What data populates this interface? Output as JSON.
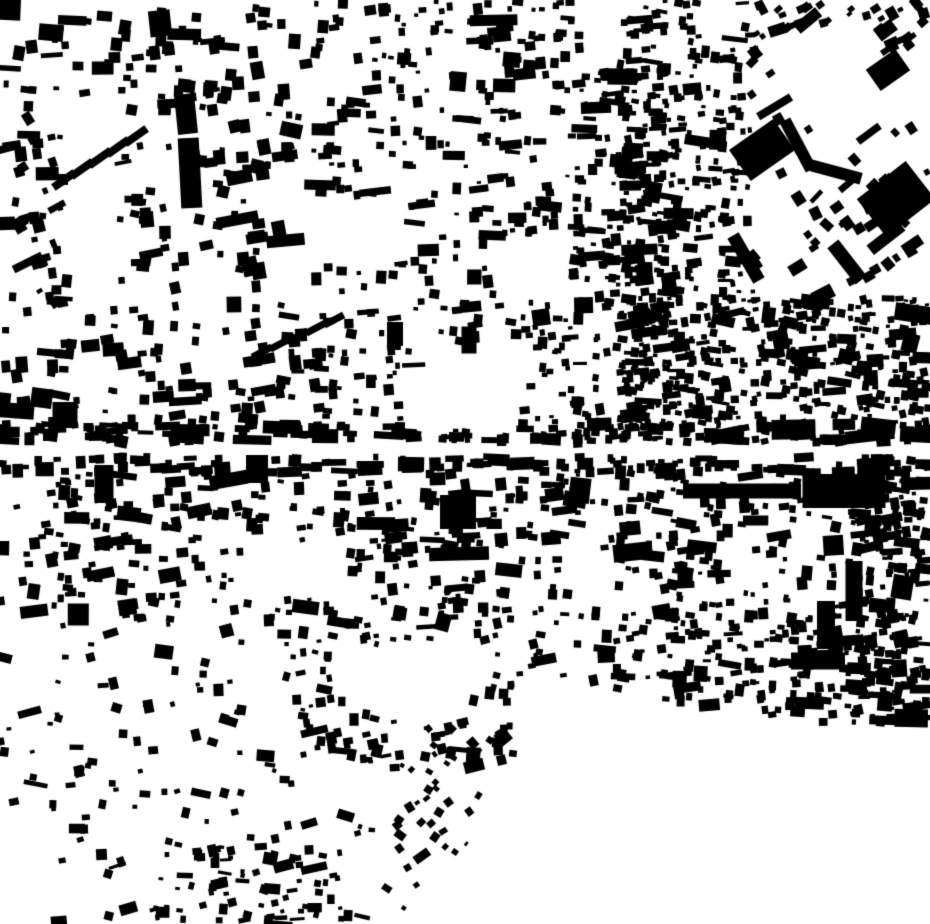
{
  "map_data": {
    "type": "figure-ground-building-footprints",
    "description": "Monochrome figure-ground map of a dense urban fabric: black building footprints on a white ground. Dense fine-grain blocks to the east, large industrial/estate slabs in the north-east, twin tall slab buildings in the north-west, a horizontal street corridor across the middle lined with row buildings, a large commercial slab at centre-right, and an empty (unbuilt) wedge in the south-east corner.",
    "width": 930,
    "height": 924,
    "background_color": "#ffffff",
    "building_color": "#000000",
    "seed": 7,
    "base_elongation_chance": 0.15,
    "big_building_chance": 0.06,
    "districts": [
      {
        "name": "top-left-upper",
        "x": 6,
        "y": 4,
        "w": 300,
        "h": 112,
        "count": 85,
        "min": 5,
        "max": 13,
        "angle": 0,
        "jitter": 10
      },
      {
        "name": "left-edge-upper",
        "x": 0,
        "y": 118,
        "w": 72,
        "h": 195,
        "count": 48,
        "min": 5,
        "max": 12,
        "angle": -12,
        "jitter": 22
      },
      {
        "name": "top-left-mid",
        "x": 120,
        "y": 115,
        "w": 190,
        "h": 195,
        "count": 80,
        "min": 5,
        "max": 14,
        "angle": 0,
        "jitter": 14
      },
      {
        "name": "top-center-a",
        "x": 310,
        "y": 0,
        "w": 155,
        "h": 310,
        "count": 150,
        "min": 4,
        "max": 11,
        "angle": 0,
        "jitter": 8
      },
      {
        "name": "top-center-b",
        "x": 465,
        "y": 0,
        "w": 115,
        "h": 310,
        "count": 150,
        "min": 4,
        "max": 11,
        "angle": 0,
        "jitter": 8
      },
      {
        "name": "central-dense-column",
        "x": 575,
        "y": 60,
        "w": 105,
        "h": 395,
        "count": 250,
        "min": 4,
        "max": 10,
        "angle": 0,
        "jitter": 10
      },
      {
        "name": "top-right-finegrain",
        "x": 620,
        "y": 0,
        "w": 135,
        "h": 300,
        "count": 230,
        "min": 4,
        "max": 9,
        "angle": 0,
        "jitter": 12
      },
      {
        "name": "top-right-corner",
        "x": 755,
        "y": 0,
        "w": 175,
        "h": 55,
        "count": 55,
        "min": 5,
        "max": 11,
        "angle": -30,
        "jitter": 15
      },
      {
        "name": "top-right-estates",
        "x": 750,
        "y": 55,
        "w": 180,
        "h": 255,
        "count": 60,
        "min": 5,
        "max": 13,
        "angle": -36,
        "jitter": 12
      },
      {
        "name": "mid-left-band",
        "x": 0,
        "y": 310,
        "w": 310,
        "h": 132,
        "count": 120,
        "min": 5,
        "max": 12,
        "angle": 0,
        "jitter": 12
      },
      {
        "name": "mid-center-band",
        "x": 310,
        "y": 310,
        "w": 270,
        "h": 132,
        "count": 140,
        "min": 4,
        "max": 11,
        "angle": 0,
        "jitter": 10
      },
      {
        "name": "mid-right-dense",
        "x": 620,
        "y": 298,
        "w": 310,
        "h": 145,
        "count": 420,
        "min": 4,
        "max": 9,
        "angle": 0,
        "jitter": 14
      },
      {
        "name": "street-north-row",
        "x": 0,
        "y": 424,
        "w": 930,
        "h": 17,
        "count": 115,
        "min": 5,
        "max": 10,
        "angle": 0,
        "jitter": 4,
        "elong": 0.45
      },
      {
        "name": "street-south-row",
        "x": 0,
        "y": 457,
        "w": 930,
        "h": 16,
        "count": 130,
        "min": 5,
        "max": 11,
        "angle": 0,
        "jitter": 4,
        "elong": 0.45
      },
      {
        "name": "lower-left",
        "x": 0,
        "y": 473,
        "w": 305,
        "h": 150,
        "count": 150,
        "min": 5,
        "max": 12,
        "angle": 0,
        "jitter": 12
      },
      {
        "name": "lower-center",
        "x": 305,
        "y": 473,
        "w": 315,
        "h": 145,
        "count": 185,
        "min": 4,
        "max": 11,
        "angle": 0,
        "jitter": 10
      },
      {
        "name": "lower-right",
        "x": 620,
        "y": 473,
        "w": 310,
        "h": 145,
        "count": 190,
        "min": 4,
        "max": 11,
        "angle": 0,
        "jitter": 12
      },
      {
        "name": "right-edge-dense",
        "x": 852,
        "y": 443,
        "w": 78,
        "h": 280,
        "count": 150,
        "min": 4,
        "max": 9,
        "angle": 0,
        "jitter": 14
      },
      {
        "name": "bottom-left-sparse",
        "x": 0,
        "y": 623,
        "w": 300,
        "h": 190,
        "count": 78,
        "min": 4,
        "max": 10,
        "angle": 0,
        "jitter": 18
      },
      {
        "name": "bottom-center",
        "x": 300,
        "y": 618,
        "w": 320,
        "h": 150,
        "count": 170,
        "min": 4,
        "max": 10,
        "angle": 0,
        "jitter": 15
      },
      {
        "name": "bottom-right-band",
        "x": 620,
        "y": 614,
        "w": 310,
        "h": 112,
        "count": 210,
        "min": 4,
        "max": 10,
        "angle": 0,
        "jitter": 10
      },
      {
        "name": "deep-bottom-left",
        "x": 55,
        "y": 815,
        "w": 330,
        "h": 108,
        "count": 55,
        "min": 4,
        "max": 9,
        "angle": 0,
        "jitter": 20
      },
      {
        "name": "riverside-diagonal",
        "x": 385,
        "y": 728,
        "w": 175,
        "h": 196,
        "count": 80,
        "min": 4,
        "max": 9,
        "angle": -45,
        "jitter": 15
      },
      {
        "name": "bottom-edge-cluster",
        "x": 150,
        "y": 848,
        "w": 200,
        "h": 76,
        "count": 48,
        "min": 4,
        "max": 9,
        "angle": 0,
        "jitter": 15
      }
    ],
    "landmarks": [
      {
        "name": "nw-tower-slab-upper",
        "cx": 186,
        "cy": 114,
        "w": 20,
        "h": 40,
        "a": -6
      },
      {
        "name": "nw-tower-slab-lower",
        "cx": 190,
        "cy": 173,
        "w": 21,
        "h": 70,
        "a": -3
      },
      {
        "name": "ne-estate-block",
        "cx": 762,
        "cy": 150,
        "w": 54,
        "h": 38,
        "a": -35
      },
      {
        "name": "ne-estate-strip",
        "cx": 798,
        "cy": 145,
        "w": 12,
        "h": 56,
        "a": -28
      },
      {
        "name": "ne-estate-elbow",
        "cx": 836,
        "cy": 172,
        "w": 52,
        "h": 12,
        "a": 15
      },
      {
        "name": "ne-big-slab",
        "cx": 896,
        "cy": 199,
        "w": 62,
        "h": 48,
        "a": -38
      },
      {
        "name": "ne-slab-strip-a",
        "cx": 886,
        "cy": 238,
        "w": 40,
        "h": 12,
        "a": -38
      },
      {
        "name": "ne-slab-strip-b",
        "cx": 847,
        "cy": 262,
        "w": 14,
        "h": 46,
        "a": -38
      },
      {
        "name": "ne-slab-strip-c",
        "cx": 746,
        "cy": 258,
        "w": 13,
        "h": 52,
        "a": -30
      },
      {
        "name": "ne-corner-block",
        "cx": 888,
        "cy": 70,
        "w": 36,
        "h": 26,
        "a": -35
      },
      {
        "name": "center-right-mega-slab",
        "cx": 844,
        "cy": 491,
        "w": 83,
        "h": 34,
        "a": 0
      },
      {
        "name": "center-right-row-slab",
        "cx": 742,
        "cy": 491,
        "w": 118,
        "h": 15,
        "a": 0
      },
      {
        "name": "west-block",
        "cx": 104,
        "cy": 484,
        "w": 19,
        "h": 38,
        "a": 0
      },
      {
        "name": "center-west-block",
        "cx": 257,
        "cy": 469,
        "w": 22,
        "h": 28,
        "a": 0
      },
      {
        "name": "central-block",
        "cx": 458,
        "cy": 512,
        "w": 36,
        "h": 34,
        "a": 0
      },
      {
        "name": "mid-bar-a",
        "cx": 395,
        "cy": 334,
        "w": 16,
        "h": 24,
        "a": 0
      },
      {
        "name": "mid-bar-b",
        "cx": 469,
        "cy": 340,
        "w": 15,
        "h": 27,
        "a": 0
      },
      {
        "name": "west-mid-block",
        "cx": 65,
        "cy": 415,
        "w": 25,
        "h": 26,
        "a": 0
      },
      {
        "name": "east-bar-a",
        "cx": 854,
        "cy": 591,
        "w": 17,
        "h": 60,
        "a": 0
      },
      {
        "name": "east-bar-b",
        "cx": 826,
        "cy": 625,
        "w": 18,
        "h": 48,
        "a": 0
      },
      {
        "name": "east-bar-c",
        "cx": 818,
        "cy": 661,
        "w": 54,
        "h": 17,
        "a": 0
      },
      {
        "name": "nw-terrace-1",
        "cx": 64,
        "cy": 180,
        "w": 26,
        "h": 8,
        "a": -35
      },
      {
        "name": "nw-terrace-2",
        "cx": 82,
        "cy": 169,
        "w": 26,
        "h": 8,
        "a": -35
      },
      {
        "name": "nw-terrace-3",
        "cx": 100,
        "cy": 158,
        "w": 26,
        "h": 8,
        "a": -35
      },
      {
        "name": "nw-terrace-4",
        "cx": 118,
        "cy": 147,
        "w": 26,
        "h": 8,
        "a": -35
      },
      {
        "name": "nw-terrace-5",
        "cx": 136,
        "cy": 136,
        "w": 26,
        "h": 8,
        "a": -35
      },
      {
        "name": "mid-terrace-1",
        "cx": 262,
        "cy": 352,
        "w": 22,
        "h": 7,
        "a": -28
      },
      {
        "name": "mid-terrace-2",
        "cx": 280,
        "cy": 344,
        "w": 22,
        "h": 7,
        "a": -28
      },
      {
        "name": "mid-terrace-3",
        "cx": 298,
        "cy": 336,
        "w": 22,
        "h": 7,
        "a": -28
      },
      {
        "name": "mid-terrace-4",
        "cx": 316,
        "cy": 328,
        "w": 22,
        "h": 7,
        "a": -28
      },
      {
        "name": "mid-terrace-5",
        "cx": 334,
        "cy": 320,
        "w": 22,
        "h": 7,
        "a": -28
      }
    ],
    "voids": {
      "rects": [
        {
          "name": "central-street",
          "x": 0,
          "y": 443,
          "w": 930,
          "h": 13
        },
        {
          "name": "plaza-a",
          "x": 296,
          "y": 196,
          "w": 112,
          "h": 66
        },
        {
          "name": "plaza-b",
          "x": 425,
          "y": 345,
          "w": 95,
          "h": 85
        },
        {
          "name": "plaza-c",
          "x": 240,
          "y": 540,
          "w": 110,
          "h": 58
        },
        {
          "name": "plaza-d",
          "x": 333,
          "y": 645,
          "w": 155,
          "h": 55
        },
        {
          "name": "plaza-e",
          "x": 498,
          "y": 240,
          "w": 62,
          "h": 62
        }
      ],
      "polygons": [
        {
          "name": "southeast-unbuilt-wedge",
          "points": [
            [
              548,
              682
            ],
            [
              930,
              740
            ],
            [
              930,
              924
            ],
            [
              428,
              924
            ],
            [
              505,
              772
            ]
          ]
        },
        {
          "name": "northeast-diamond-open-space",
          "points": [
            [
              762,
              34
            ],
            [
              870,
              20
            ],
            [
              898,
              108
            ],
            [
              800,
              130
            ]
          ]
        }
      ]
    }
  }
}
